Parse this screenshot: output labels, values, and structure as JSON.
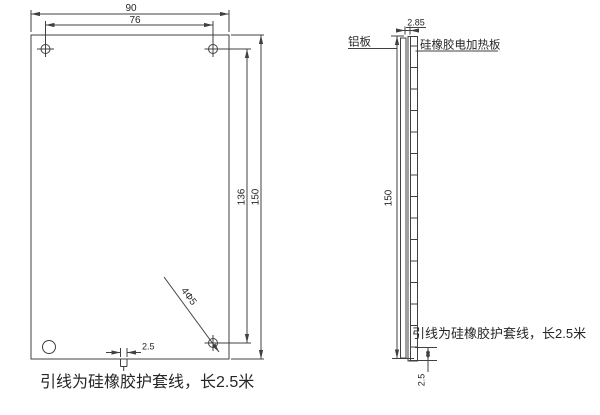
{
  "front_view": {
    "width_total": "90",
    "hole_spacing_h": "76",
    "hole_spacing_v": "136",
    "height_total": "150",
    "wire_width": "2.5",
    "holes_note": "4Φ5",
    "lead_note": "引线为硅橡胶护套线，长2.5米"
  },
  "side_view": {
    "thickness": "2.85",
    "aluminum_label": "铝板",
    "heater_label": "硅橡胶电加热板",
    "height_total": "150",
    "wire_exit": "2.5",
    "lead_note": "引线为硅橡胶护套线，长2.5米"
  },
  "colors": {
    "line": "#404040",
    "text": "#262626",
    "background": "#ffffff"
  }
}
